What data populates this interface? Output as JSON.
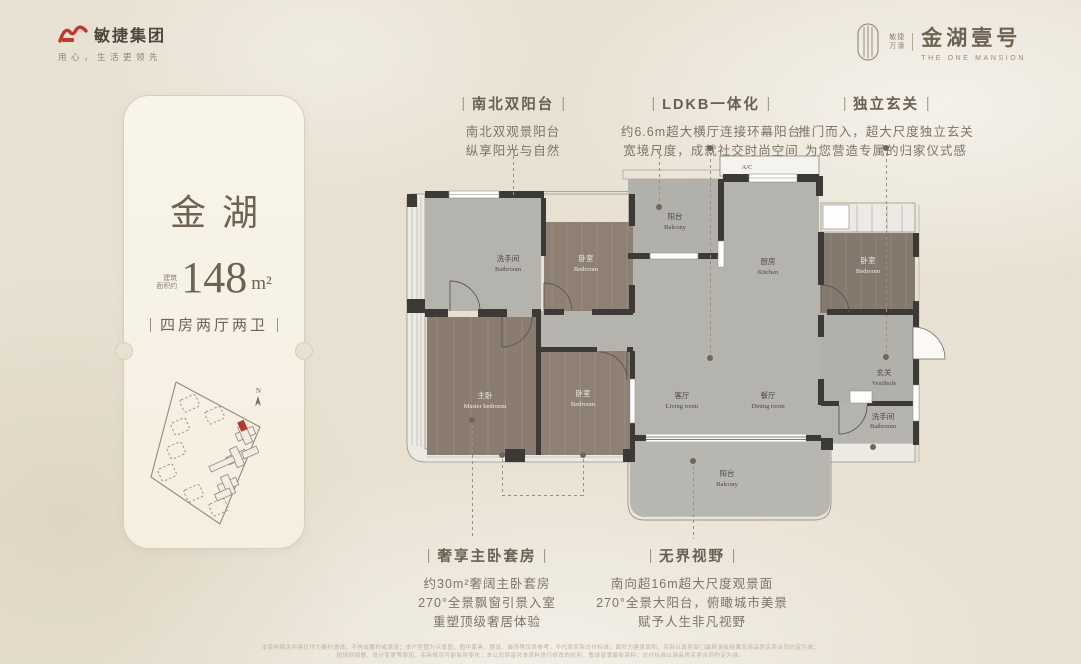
{
  "colors": {
    "background": "#e8e1d2",
    "accent_red": "#c0392e",
    "wall_dark": "#3c3a36",
    "floor_gray": "#b5b3ae",
    "floor_wood": "#8e8174",
    "text_brown": "#6f6557",
    "highlight_unit_red": "#b5382f"
  },
  "header": {
    "group_logo_text": "敏捷集团",
    "group_slogan": "用心，生活更领先",
    "project_brand_line1": "敏捷",
    "project_brand_line2": "万濠",
    "project_name": "金湖壹号",
    "project_name_en": "THE ONE MANSION"
  },
  "unit_card": {
    "title": "金湖",
    "area_prefix_line1": "建筑",
    "area_prefix_line2": "面积约",
    "area_value": "148",
    "area_unit": "m²",
    "layout": "四房两厅两卫",
    "siteplan_north_label": "N"
  },
  "callouts": {
    "top": [
      {
        "title": "南北双阳台",
        "lines": [
          "南北双观景阳台",
          "纵享阳光与自然"
        ]
      },
      {
        "title": "LDKB一体化",
        "lines": [
          "约6.6m超大横厅连接环幕阳台",
          "宽境尺度，成就社交时尚空间"
        ]
      },
      {
        "title": "独立玄关",
        "lines": [
          "推门而入，超大尺度独立玄关",
          "为您营造专属的归家仪式感"
        ]
      }
    ],
    "bottom": [
      {
        "title": "奢享主卧套房",
        "lines": [
          "约30m²奢阔主卧套房",
          "270°全景飘窗引景入室",
          "重塑顶级奢居体验"
        ]
      },
      {
        "title": "无界视野",
        "lines": [
          "南向超16m超大尺度观景面",
          "270°全景大阳台，俯瞰城市美景",
          "赋予人生非凡视野"
        ]
      }
    ]
  },
  "floor_plan": {
    "rooms": {
      "bathroom_nw": {
        "zh": "洗手间",
        "en": "Bathroom"
      },
      "bedroom_nw": {
        "zh": "卧室",
        "en": "Bedroom"
      },
      "master": {
        "zh": "主卧",
        "en": "Master bedroom"
      },
      "bedroom_w": {
        "zh": "卧室",
        "en": "Bedroom"
      },
      "balcony_n": {
        "zh": "阳台",
        "en": "Balcony"
      },
      "kitchen": {
        "zh": "厨房",
        "en": "Kitchen"
      },
      "ac_platform": {
        "label": "A/C"
      },
      "bedroom_e": {
        "zh": "卧室",
        "en": "Bedroom"
      },
      "vestibule": {
        "zh": "玄关",
        "en": "Vestibule"
      },
      "bathroom_e": {
        "zh": "洗手间",
        "en": "Bathroom"
      },
      "living": {
        "zh": "客厅",
        "en": "Living room"
      },
      "dining": {
        "zh": "餐厅",
        "en": "Dining room"
      },
      "balcony_s": {
        "zh": "阳台",
        "en": "Balcony"
      }
    }
  },
  "footer": {
    "line1": "本资料相关内容仅作为要约邀请，不构成要约或承诺；本户型图为示意图，图中家具、摆设、装饰等仅供参考，不代表实际交付标准；面积为建筑面积，实际以政府部门最终测绘结果及商品房买卖合同约定为准；",
    "line2": "因规划调整、设计变更等原因，实际情况可能有所变化，本公司保留对本资料进行修改的权利，敬请留意最新资料；交付标准以商品房买卖合同约定为准。"
  }
}
